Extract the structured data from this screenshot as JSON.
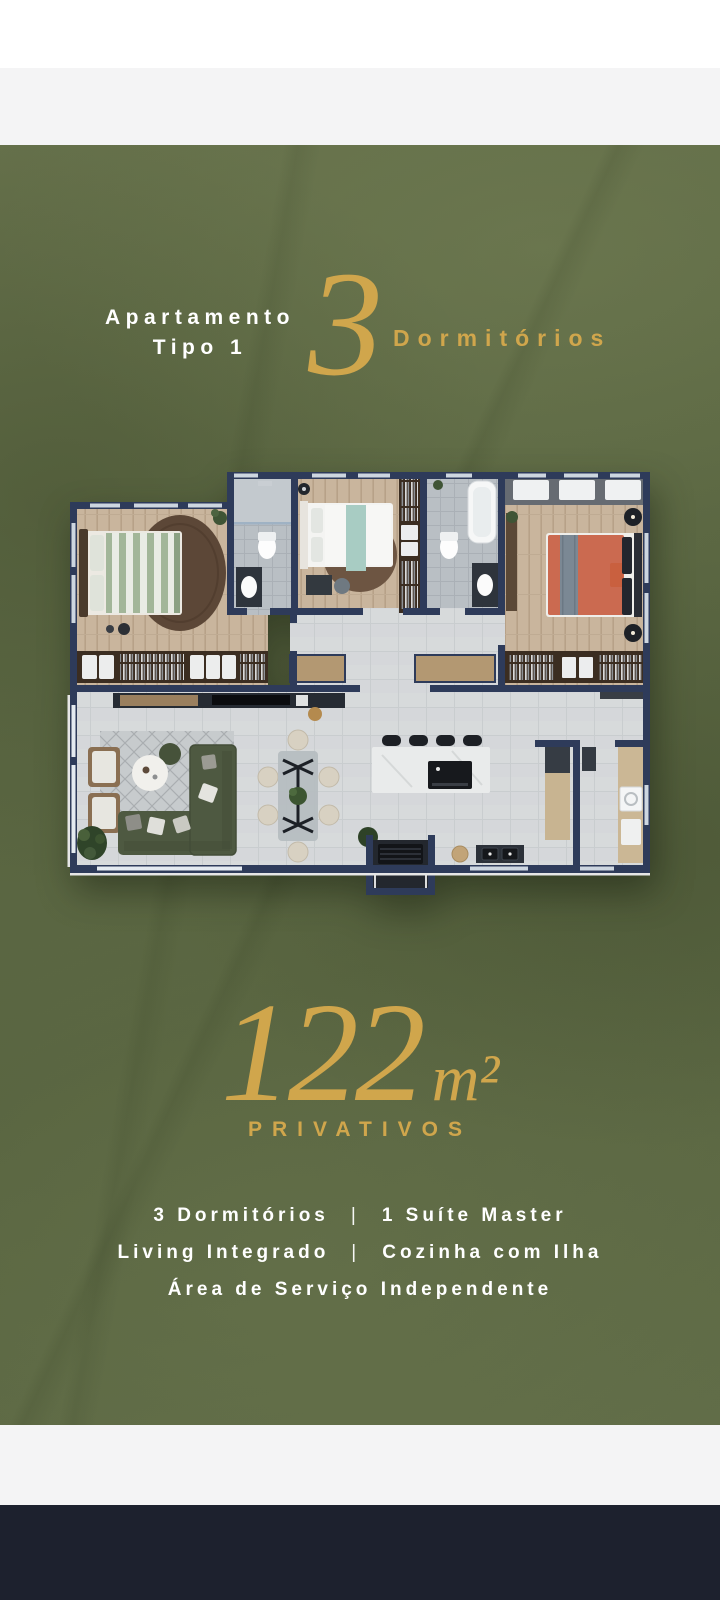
{
  "header": {
    "line1": "Apartamento",
    "line2": "Tipo 1",
    "number": "3",
    "number_label": "Dormitórios"
  },
  "area": {
    "value": "122",
    "unit": "m²",
    "label": "PRIVATIVOS"
  },
  "features": {
    "separator": "|",
    "rows": [
      {
        "left": "3 Dormitórios",
        "right": "1 Suíte Master"
      },
      {
        "left": "Living Integrado",
        "right": "Cozinha com Ilha"
      },
      {
        "center": "Área de Serviço Independente"
      }
    ]
  },
  "colors": {
    "gold": "#d0a64c",
    "olive_background": "#5e6a45",
    "wall_navy": "#2e3b5a",
    "footer_navy": "#1d212e",
    "panel_gray": "#f4f4f5",
    "text_white": "#ffffff"
  }
}
